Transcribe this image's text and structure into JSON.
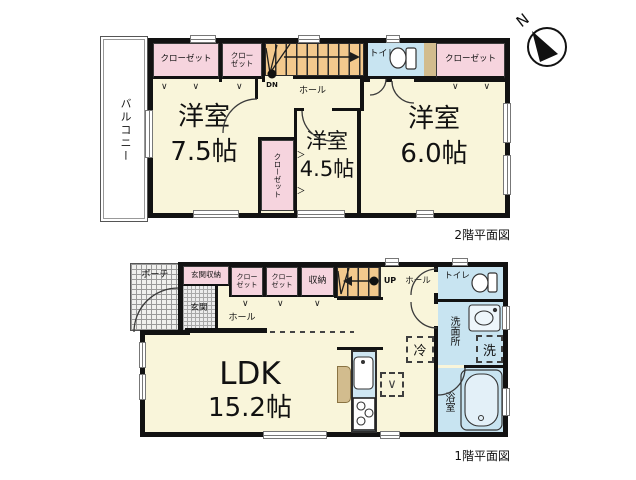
{
  "compass": {
    "label": "N"
  },
  "floor2": {
    "caption": "2階平面図",
    "balcony": "バルコニー",
    "closet_nw": "クローゼット",
    "closet_nw2": "クロー\nゼット",
    "closet_ne": "クローゼット",
    "closet_mid": "クローゼット",
    "hall": "ホール",
    "toilet": "トイレ",
    "stairs_dn": "DN",
    "room_w_name": "洋室",
    "room_w_size": "7.5帖",
    "room_c_name": "洋室",
    "room_c_size": "4.5帖",
    "room_e_name": "洋室",
    "room_e_size": "6.0帖"
  },
  "floor1": {
    "caption": "1階平面図",
    "porch": "ポーチ",
    "entrance_storage": "玄関収納",
    "entrance": "玄関",
    "hall_w": "ホール",
    "hall_e": "ホール",
    "closet_a": "クロー\nゼット",
    "closet_b": "クロー\nゼット",
    "storage": "収納",
    "stairs_up": "UP",
    "toilet": "トイレ",
    "washroom": "洗面所",
    "washer": "洗",
    "fridge": "冷",
    "bath": "浴室",
    "ldk_name": "LDK",
    "ldk_size": "15.2帖",
    "kitchen_mark": "∨"
  },
  "marks": {
    "chev3": "∨ ∨ ∨",
    "chev2": "∨ ∨",
    "chev1": "∨",
    "chev_right": "＞"
  },
  "colors": {
    "floor_cream": "#f9f5da",
    "closet_pink": "#f6d4de",
    "water_blue": "#c8e4f1",
    "stairs_orange": "#f3c98d",
    "counter_tan": "#d2bc8e",
    "wall_black": "#121212"
  }
}
